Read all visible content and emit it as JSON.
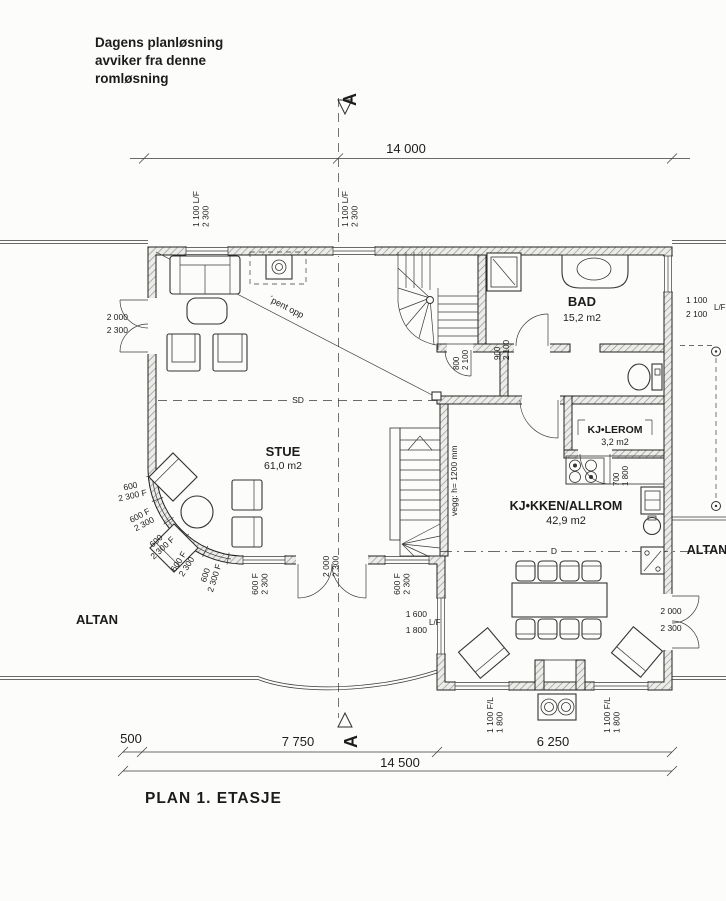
{
  "note": {
    "l1": "Dagens planløsning",
    "l2": "avviker fra denne",
    "l3": "romløsning"
  },
  "title": "PLAN  1. ETASJE",
  "section": {
    "letter_top": "A",
    "letter_bottom": "A"
  },
  "dims": {
    "top": "14 000",
    "d500": "500",
    "d7750": "7 750",
    "d6250": "6 250",
    "total": "14 500"
  },
  "rooms": {
    "stue": {
      "name": "STUE",
      "area": "61,0 m2"
    },
    "bad": {
      "name": "BAD",
      "area": "15,2 m2"
    },
    "kjolerom": {
      "name": "KJ•LEROM",
      "area": "3,2 m2"
    },
    "kjokken": {
      "name": "KJ•KKEN/ALLROM",
      "area": "42,9 m2"
    },
    "altan_left": "ALTAN",
    "altan_right": "ALTAN"
  },
  "annot": {
    "pent_opp": "´pent opp",
    "sd": "SD",
    "d": "D",
    "vegg": "vegg: h= 1200 mm"
  },
  "openings": {
    "win_top_a": {
      "l1": "1 100 L/F",
      "l2": "2 300"
    },
    "win_top_b": {
      "l1": "1 100 L/F",
      "l2": "2 300"
    },
    "door_left": {
      "l1": "2 000",
      "l2": "2 300"
    },
    "win_right": {
      "l1": "1 100",
      "l2": "2 100",
      "l3": "L/F"
    },
    "door_stue": {
      "l1": "2 000",
      "l2": "2 300"
    },
    "door_altan_right": {
      "l1": "2 000",
      "l2": "2 300"
    },
    "win_kitchen_left": {
      "l1": "1 600",
      "l2": "1 800",
      "l3": "L/F"
    },
    "win_kitchen_s1": {
      "l1": "1 100 F/L",
      "l2": "1 800"
    },
    "win_kitchen_s2": {
      "l1": "1 100 F/L",
      "l2": "1 800"
    },
    "door_stair": {
      "l1": "800",
      "l2": "2 100"
    },
    "door_bad": {
      "l1": "900",
      "l2": "2 100"
    },
    "door_kjolerom": {
      "l1": "700",
      "l2": "1 800"
    },
    "bay": [
      {
        "l1": "600",
        "l2": "2 300 F"
      },
      {
        "l1": "600 F",
        "l2": "2 300"
      },
      {
        "l1": "600",
        "l2": "2 300 F"
      },
      {
        "l1": "600 F",
        "l2": "2 300"
      },
      {
        "l1": "600",
        "l2": "2 300 F"
      },
      {
        "l1": "600 F",
        "l2": "2 300"
      },
      {
        "l1": "600 F",
        "l2": "2 300"
      }
    ]
  }
}
